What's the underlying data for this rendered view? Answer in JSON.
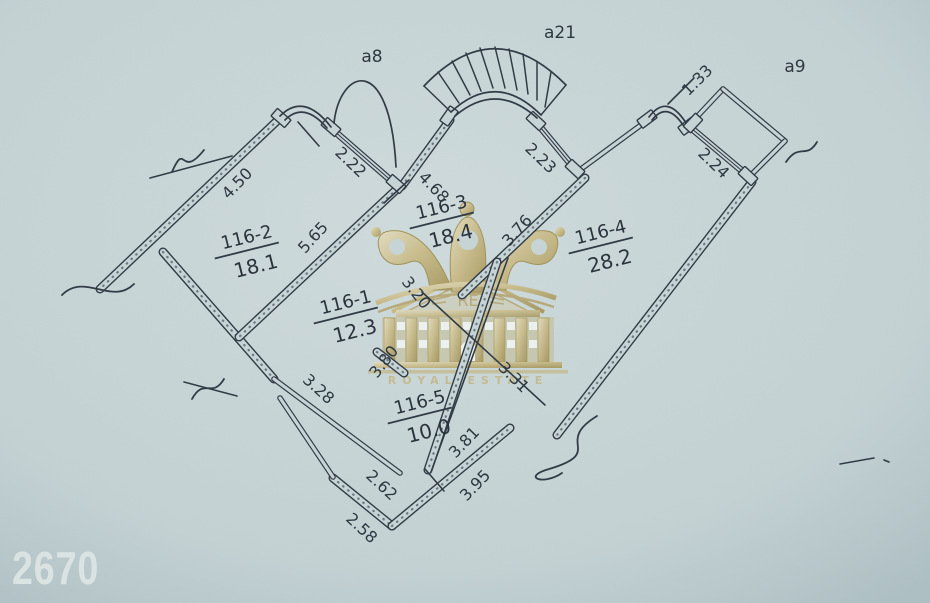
{
  "page": {
    "corner_number": "2670"
  },
  "watermark": {
    "monogram": "RE",
    "brand": "ROYAL ESTATE",
    "gold": "#b3a066",
    "gold_light": "#d8c99d",
    "gold_dark": "#97843f"
  },
  "plan": {
    "pen_color": "#323c46",
    "paper_color": "#c6d4d6",
    "rooms": [
      {
        "name": "116-2",
        "area": "18.1",
        "x": 248,
        "y": 243,
        "rot": -14
      },
      {
        "name": "116-1",
        "area": "12.3",
        "x": 347,
        "y": 308,
        "rot": -14
      },
      {
        "name": "116-3",
        "area": "18.4",
        "x": 443,
        "y": 213,
        "rot": -14
      },
      {
        "name": "116-4",
        "area": "28.2",
        "x": 602,
        "y": 238,
        "rot": -14
      },
      {
        "name": "116-5",
        "area": "10.0",
        "x": 421,
        "y": 408,
        "rot": -14
      }
    ],
    "balconies": [
      {
        "label": "а8",
        "x": 372,
        "y": 62
      },
      {
        "label": "а21",
        "x": 560,
        "y": 38
      },
      {
        "label": "а9",
        "x": 795,
        "y": 72
      }
    ],
    "dimensions": [
      {
        "value": "4.50",
        "x": 241,
        "y": 187,
        "rot": -46
      },
      {
        "value": "2.22",
        "x": 347,
        "y": 166,
        "rot": 44
      },
      {
        "value": "5.65",
        "x": 317,
        "y": 241,
        "rot": -48
      },
      {
        "value": "4.68",
        "x": 430,
        "y": 191,
        "rot": 46
      },
      {
        "value": "2.23",
        "x": 537,
        "y": 162,
        "rot": 44
      },
      {
        "value": "3.76",
        "x": 521,
        "y": 234,
        "rot": -48
      },
      {
        "value": "1.33",
        "x": 701,
        "y": 84,
        "rot": -45
      },
      {
        "value": "2.24",
        "x": 710,
        "y": 167,
        "rot": 44
      },
      {
        "value": "3.20",
        "x": 412,
        "y": 296,
        "rot": 52
      },
      {
        "value": "3.80",
        "x": 388,
        "y": 365,
        "rot": -52
      },
      {
        "value": "3.31",
        "x": 510,
        "y": 381,
        "rot": 45
      },
      {
        "value": "3.28",
        "x": 315,
        "y": 393,
        "rot": 42
      },
      {
        "value": "2.62",
        "x": 378,
        "y": 489,
        "rot": 43
      },
      {
        "value": "2.58",
        "x": 358,
        "y": 532,
        "rot": 43
      },
      {
        "value": "3.95",
        "x": 479,
        "y": 489,
        "rot": -46
      },
      {
        "value": "3.81",
        "x": 468,
        "y": 446,
        "rot": -46
      }
    ],
    "walls": [
      [
        278,
        120,
        100,
        289,
        "T"
      ],
      [
        163,
        252,
        274,
        379,
        "T"
      ],
      [
        274,
        379,
        400,
        473,
        "P"
      ],
      [
        397,
        189,
        239,
        337,
        "T"
      ],
      [
        402,
        186,
        450,
        120,
        "T"
      ],
      [
        577,
        172,
        645,
        122,
        "P"
      ],
      [
        574,
        168,
        586,
        179,
        "P"
      ],
      [
        585,
        178,
        462,
        295,
        "T"
      ],
      [
        752,
        182,
        557,
        435,
        "T"
      ],
      [
        497,
        262,
        428,
        470,
        "T"
      ],
      [
        333,
        478,
        392,
        526,
        "T"
      ],
      [
        392,
        526,
        510,
        428,
        "T"
      ],
      [
        280,
        398,
        333,
        477,
        "P"
      ],
      [
        377,
        352,
        404,
        373,
        "T"
      ],
      [
        693,
        121,
        723,
        89,
        "P"
      ],
      [
        723,
        89,
        785,
        141,
        "P"
      ],
      [
        785,
        141,
        753,
        173,
        "P"
      ],
      [
        333,
        130,
        395,
        184,
        "W"
      ],
      [
        536,
        122,
        574,
        168,
        "W"
      ],
      [
        691,
        128,
        747,
        175,
        "W"
      ]
    ],
    "jambs": [
      [
        281,
        118,
        41
      ],
      [
        331,
        127,
        41
      ],
      [
        396,
        184,
        41
      ],
      [
        449,
        116,
        -55
      ],
      [
        536,
        121,
        43
      ],
      [
        575,
        169,
        43
      ],
      [
        647,
        119,
        -37
      ],
      [
        688,
        126,
        -37
      ],
      [
        748,
        176,
        43
      ],
      [
        693,
        123,
        -47
      ]
    ],
    "arcs": [
      "M280,116 Q304,92 331,127",
      "M285,120 Q304,101 327,128",
      "M334,123 C340,68 390,52 396,167",
      "M424,86 Q494,12 566,85",
      "M451,112 Q496,70 541,115",
      "M455,116 Q496,81 537,118",
      "M649,117 Q667,93 686,123",
      "M652,120 Q667,101 683,125"
    ],
    "rays": [
      [
        424,
        86,
        451,
        112
      ],
      [
        438,
        72,
        459,
        103
      ],
      [
        452,
        61,
        470,
        95
      ],
      [
        466,
        53,
        481,
        91
      ],
      [
        480,
        48,
        493,
        88
      ],
      [
        495,
        47,
        505,
        88
      ],
      [
        509,
        49,
        517,
        90
      ],
      [
        523,
        54,
        528,
        94
      ],
      [
        537,
        62,
        537,
        100
      ],
      [
        551,
        72,
        545,
        107
      ],
      [
        566,
        85,
        541,
        115
      ]
    ],
    "pen_lines": [
      [
        298,
        122,
        319,
        146
      ],
      [
        384,
        203,
        409,
        180
      ],
      [
        150,
        178,
        232,
        156
      ],
      [
        184,
        382,
        237,
        396
      ],
      [
        422,
        292,
        545,
        405
      ],
      [
        508,
        258,
        431,
        472
      ],
      [
        425,
        469,
        444,
        491
      ],
      [
        668,
        104,
        694,
        78
      ],
      [
        840,
        464,
        874,
        458
      ],
      [
        884,
        460,
        889,
        462
      ]
    ],
    "squiggles": [
      "M62,295 C85,272 112,306 134,284",
      "M172,172 C186,140 180,180 204,150",
      "M192,399 C204,377 212,399 224,379",
      "M597,416 C553,443 606,452 549,469 C521,477 543,486 562,473",
      "M786,162 C800,142 806,160 817,142"
    ]
  }
}
